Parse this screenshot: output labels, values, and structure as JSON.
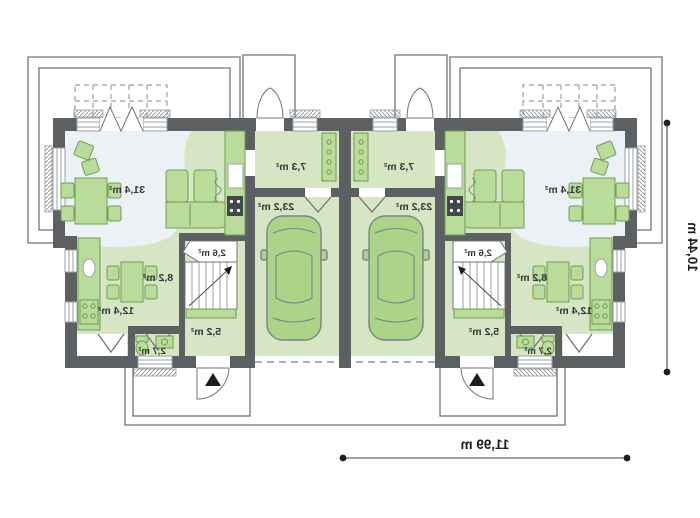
{
  "page": {
    "background": "#ffffff",
    "kind": "architectural-floor-plan",
    "mirrored_text": true
  },
  "plan": {
    "units": [
      {
        "side": "left",
        "rooms": [
          {
            "name": "living-dining-room",
            "area": "31,4 m²"
          },
          {
            "name": "vestibule",
            "area": "7,3 m²"
          },
          {
            "name": "garage",
            "area": "23,2 m²"
          },
          {
            "name": "under-stairs-storage",
            "area": "2,6 m²"
          },
          {
            "name": "kitchen",
            "area": "8,2 m²"
          },
          {
            "name": "room",
            "area": "12,4 m²"
          },
          {
            "name": "hall",
            "area": "5,2 m²"
          },
          {
            "name": "wc",
            "area": "2,7 m²"
          }
        ]
      },
      {
        "side": "right",
        "rooms": [
          {
            "name": "living-dining-room",
            "area": "31,4 m²"
          },
          {
            "name": "vestibule",
            "area": "7,3 m²"
          },
          {
            "name": "garage",
            "area": "23,2 m²"
          },
          {
            "name": "under-stairs-storage",
            "area": "2,6 m²"
          },
          {
            "name": "kitchen",
            "area": "8,2 m²"
          },
          {
            "name": "room",
            "area": "12,4 m²"
          },
          {
            "name": "hall",
            "area": "5,2 m²"
          },
          {
            "name": "wc",
            "area": "2,7 m²"
          }
        ]
      }
    ],
    "dimensions": {
      "total_width": "11,99 m",
      "total_depth": "10,44 m"
    },
    "markers": {
      "entrance_arrow": "▲"
    },
    "colors": {
      "wall": "#5c6063",
      "floor_green": "#d6e5c4",
      "floor_pale": "#ecf1f6",
      "furniture": "#b9dc9b",
      "furniture_stroke": "#6f9b55",
      "car": "#abd489",
      "line": "#70757a",
      "text": "#33373a"
    }
  }
}
